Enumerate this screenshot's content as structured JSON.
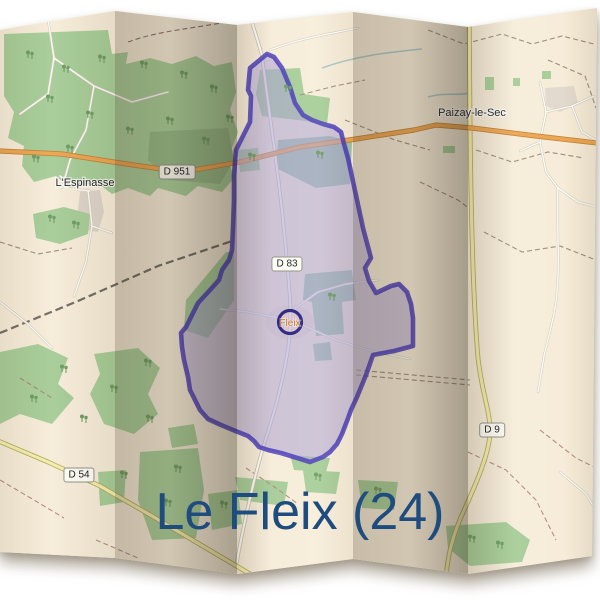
{
  "title": {
    "text": "Le Fleix (24)",
    "color": "#1e4c7e"
  },
  "places": {
    "espinasse": "L'Espinasse",
    "paizay": "Paizay-le-Sec",
    "fleix": "Fleix"
  },
  "shields": {
    "d951": "D 951",
    "d83": "D 83",
    "d54": "D 54",
    "d9": "D 9"
  },
  "map_colors": {
    "paper": "#f6ecd8",
    "forest": "#a5cc96",
    "commune_fill": "#a79fd2",
    "commune_boundary": "#3e2fb8",
    "primary_road": "#eda44d",
    "secondary_road": "#f3eeab",
    "minor_road": "#fefdf8",
    "village_label": "#c2701e",
    "title_blue": "#1e4c7e"
  }
}
